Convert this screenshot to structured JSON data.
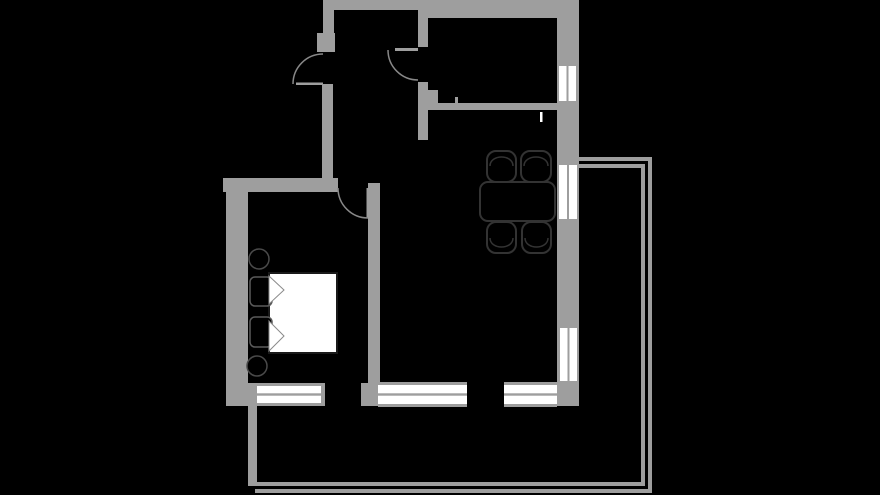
{
  "canvas": {
    "width": 880,
    "height": 495,
    "background": "#000000"
  },
  "palette": {
    "wall": "#9e9e9e",
    "window_white": "#ffffff",
    "swing_line": "#888888",
    "furniture_stroke": "#333333",
    "furniture_fill": "#000000",
    "bed_fill": "#ffffff",
    "bed_stroke": "#1a1a1a",
    "pillow_stroke": "#5a5a5a",
    "fold_stroke": "#8a8a8a",
    "stool_stroke": "#4a4a4a"
  },
  "walls": [
    {
      "name": "top-wall",
      "x": 323,
      "y": 0,
      "w": 255,
      "h": 10
    },
    {
      "name": "top-wall-right-thick",
      "x": 425,
      "y": 8,
      "w": 153,
      "h": 10
    },
    {
      "name": "right-wall",
      "x": 557,
      "y": 0,
      "w": 22,
      "h": 406
    },
    {
      "name": "entry-wall-upper",
      "x": 323,
      "y": 0,
      "w": 11,
      "h": 52
    },
    {
      "name": "entry-door-pier",
      "x": 317,
      "y": 33,
      "w": 18,
      "h": 19
    },
    {
      "name": "hall-left-wall",
      "x": 322,
      "y": 84,
      "w": 11,
      "h": 108
    },
    {
      "name": "bedroom-top-wall",
      "x": 223,
      "y": 178,
      "w": 115,
      "h": 14
    },
    {
      "name": "bedroom-left-wall",
      "x": 226,
      "y": 178,
      "w": 22,
      "h": 228
    },
    {
      "name": "bedroom-right-wall",
      "x": 368,
      "y": 183,
      "w": 12,
      "h": 200
    },
    {
      "name": "hall-room-wall-upper",
      "x": 418,
      "y": 9,
      "w": 10,
      "h": 38
    },
    {
      "name": "hall-room-wall-lower",
      "x": 418,
      "y": 82,
      "w": 10,
      "h": 58
    },
    {
      "name": "kitchen-wall-pier",
      "x": 426,
      "y": 90,
      "w": 12,
      "h": 20
    },
    {
      "name": "kitchen-partition-wall",
      "x": 438,
      "y": 103,
      "w": 120,
      "h": 7
    },
    {
      "name": "kitchen-wall-tick",
      "x": 455,
      "y": 97,
      "w": 3,
      "h": 6
    },
    {
      "name": "bottom-wall-left-corner",
      "x": 226,
      "y": 383,
      "w": 31,
      "h": 23
    },
    {
      "name": "bedroom-window-end-cap",
      "x": 321,
      "y": 383,
      "w": 4,
      "h": 23
    },
    {
      "name": "bottom-wall-pier",
      "x": 361,
      "y": 383,
      "w": 19,
      "h": 23
    },
    {
      "name": "balcony-left-bar",
      "x": 248,
      "y": 406,
      "w": 9,
      "h": 78
    }
  ],
  "railing": [
    {
      "name": "balcony-rail-top-outer",
      "x": 579,
      "y": 157,
      "w": 73,
      "h": 4
    },
    {
      "name": "balcony-rail-top-inner",
      "x": 579,
      "y": 164,
      "w": 66,
      "h": 4
    },
    {
      "name": "balcony-rail-right-outer",
      "x": 648,
      "y": 157,
      "w": 4,
      "h": 336
    },
    {
      "name": "balcony-rail-right-inner",
      "x": 641,
      "y": 164,
      "w": 4,
      "h": 322
    },
    {
      "name": "balcony-rail-bottom-outer",
      "x": 255,
      "y": 489,
      "w": 397,
      "h": 4
    },
    {
      "name": "balcony-rail-bottom-inner",
      "x": 248,
      "y": 482,
      "w": 397,
      "h": 4
    }
  ],
  "windows": [
    {
      "name": "window-right-top",
      "orientation": "v",
      "x": 559,
      "y": 66,
      "w": 17,
      "h": 35
    },
    {
      "name": "window-right-middle",
      "orientation": "v",
      "x": 559,
      "y": 165,
      "w": 18,
      "h": 54
    },
    {
      "name": "window-right-bottom",
      "orientation": "v",
      "x": 560,
      "y": 328,
      "w": 17,
      "h": 53
    },
    {
      "name": "window-bottom-bedroom",
      "orientation": "h",
      "x": 257,
      "y": 386,
      "w": 64,
      "h": 17
    },
    {
      "name": "window-bottom-living-1",
      "orientation": "h",
      "x": 378,
      "y": 385,
      "w": 89,
      "h": 19
    },
    {
      "name": "window-bottom-living-2",
      "orientation": "h",
      "x": 504,
      "y": 385,
      "w": 53,
      "h": 19
    }
  ],
  "doors": [
    {
      "name": "entry-door",
      "leaf": {
        "x": 296,
        "y": 82.5,
        "w": 27,
        "h": 2.5
      },
      "arc": "M 293 84 A 30 30 0 0 1 323 54"
    },
    {
      "name": "hall-room-door",
      "leaf": {
        "x": 395,
        "y": 48,
        "w": 23,
        "h": 3
      },
      "arc": "M 388 50 A 30 30 0 0 0 418 80"
    },
    {
      "name": "bedroom-door",
      "leaf": {
        "x": 366.5,
        "y": 188,
        "w": 2.5,
        "h": 30
      },
      "arc": "M 338 188 A 30 30 0 0 0 368 218"
    }
  ],
  "furniture": {
    "bed": {
      "duvet": {
        "x": 269,
        "y": 273,
        "w": 68,
        "h": 80
      },
      "pillows": [
        {
          "x": 250,
          "y": 277,
          "w": 22,
          "h": 29
        },
        {
          "x": 250,
          "y": 317,
          "w": 22,
          "h": 30
        }
      ],
      "folds": [
        "269,276 284,290 269,304",
        "269,321 284,336 269,351"
      ]
    },
    "stools": [
      {
        "cx": 259,
        "cy": 259,
        "r": 10
      },
      {
        "cx": 257,
        "cy": 366,
        "r": 10
      }
    ],
    "table": {
      "x": 480,
      "y": 182,
      "w": 75,
      "h": 39,
      "rx": 8
    },
    "chairs": [
      {
        "x": 487,
        "y": 151,
        "w": 29,
        "h": 31,
        "side": "top"
      },
      {
        "x": 521,
        "y": 151,
        "w": 30,
        "h": 31,
        "side": "top"
      },
      {
        "x": 487,
        "y": 222,
        "w": 29,
        "h": 31,
        "side": "bottom"
      },
      {
        "x": 522,
        "y": 222,
        "w": 29,
        "h": 31,
        "side": "bottom"
      }
    ],
    "kitchen_door_tick": {
      "x": 540,
      "y": 112,
      "w": 2.5,
      "h": 10
    }
  }
}
